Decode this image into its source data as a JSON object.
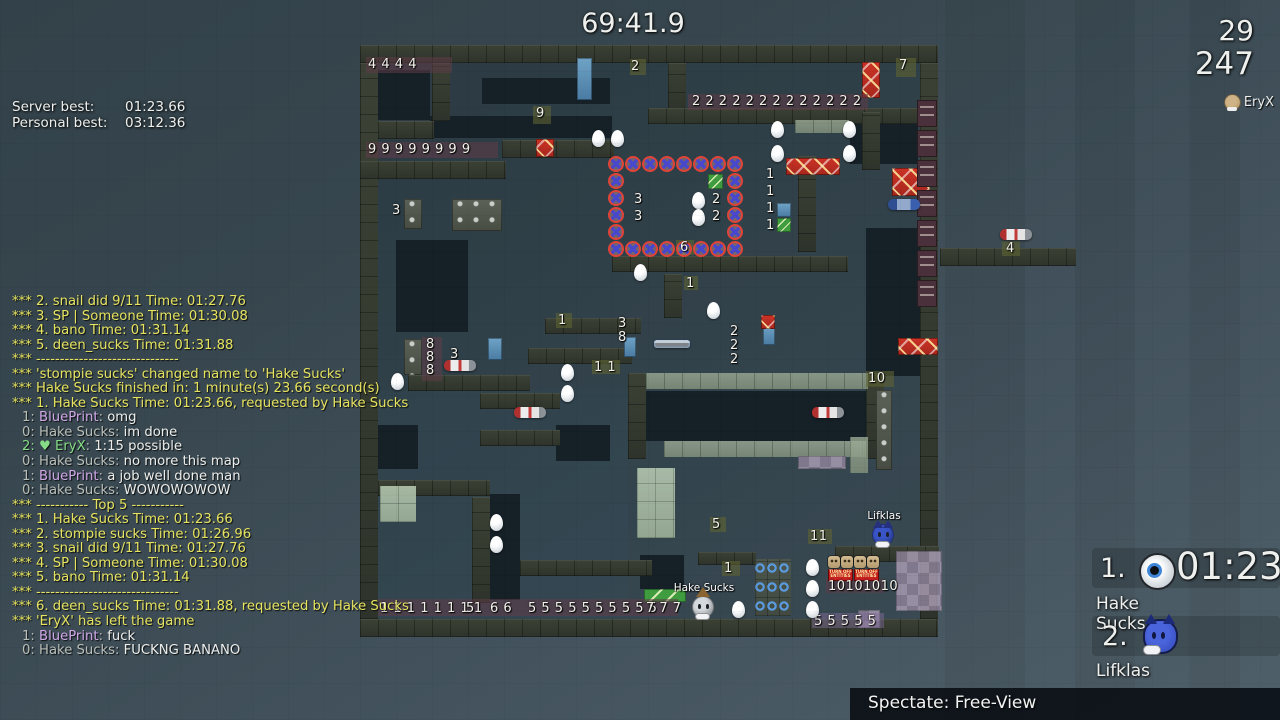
{
  "hud": {
    "timer": "69:41.9",
    "top_right": {
      "value1": "29",
      "value2": "247",
      "spectating_name": "EryX"
    },
    "bests": {
      "server_label": "Server best:",
      "server_value": "01:23.66",
      "personal_label": "Personal best:",
      "personal_value": "03:12.36"
    },
    "spectate_bar": {
      "text": "Spectate: Free-View"
    }
  },
  "chat": {
    "colors": {
      "y": "#e6e360",
      "w": "#eceeec",
      "g": "#b9bfb9",
      "p": "#d0a8e8",
      "gr": "#86dc86"
    },
    "lines": [
      [
        [
          "*** 2. snail did 9/11 Time: 01:27.76",
          "y"
        ]
      ],
      [
        [
          "*** 3. SP | Someone Time: 01:30.08",
          "y"
        ]
      ],
      [
        [
          "*** 4. bano Time: 01:31.14",
          "y"
        ]
      ],
      [
        [
          "*** 5. deen_sucks Time: 01:31.88",
          "y"
        ]
      ],
      [
        [
          "*** ------------------------------",
          "y"
        ]
      ],
      [
        [
          "*** 'stompie sucks' changed name to 'Hake Sucks'",
          "y"
        ]
      ],
      [
        [
          "*** Hake Sucks finished in: 1 minute(s) 23.66 second(s)",
          "y"
        ]
      ],
      [
        [
          "*** 1. Hake Sucks Time: 01:23.66, requested by Hake Sucks",
          "y"
        ]
      ],
      [
        [
          "1: ",
          "g"
        ],
        [
          "BluePrint",
          "p"
        ],
        [
          ": ",
          "g"
        ],
        [
          "omg",
          "w"
        ]
      ],
      [
        [
          "0: ",
          "g"
        ],
        [
          "Hake Sucks",
          "g"
        ],
        [
          ": ",
          "g"
        ],
        [
          "im done",
          "w"
        ]
      ],
      [
        [
          "2: ",
          "gr"
        ],
        [
          "♥ ",
          "gr"
        ],
        [
          "EryX",
          "gr"
        ],
        [
          ": ",
          "g"
        ],
        [
          "1:15 possible",
          "w"
        ]
      ],
      [
        [
          "0: ",
          "g"
        ],
        [
          "Hake Sucks",
          "g"
        ],
        [
          ": ",
          "g"
        ],
        [
          "no more this map",
          "w"
        ]
      ],
      [
        [
          "1: ",
          "g"
        ],
        [
          "BluePrint",
          "p"
        ],
        [
          ": ",
          "g"
        ],
        [
          "a job well done man",
          "w"
        ]
      ],
      [
        [
          "0: ",
          "g"
        ],
        [
          "Hake Sucks",
          "g"
        ],
        [
          ": ",
          "g"
        ],
        [
          "WOWOWOWOW",
          "w"
        ]
      ],
      [
        [
          "*** ----------- Top 5 -----------",
          "y"
        ]
      ],
      [
        [
          "*** 1. Hake Sucks Time: 01:23.66",
          "y"
        ]
      ],
      [
        [
          "*** 2. stompie sucks Time: 01:26.96",
          "y"
        ]
      ],
      [
        [
          "*** 3. snail did 9/11 Time: 01:27.76",
          "y"
        ]
      ],
      [
        [
          "*** 4. SP | Someone Time: 01:30.08",
          "y"
        ]
      ],
      [
        [
          "*** 5. bano Time: 01:31.14",
          "y"
        ]
      ],
      [
        [
          "*** ------------------------------",
          "y"
        ]
      ],
      [
        [
          "*** 6. deen_sucks Time: 01:31.88, requested by Hake Sucks",
          "y"
        ]
      ],
      [
        [
          "*** 'EryX' has left the game",
          "y"
        ]
      ],
      [
        [
          "1: ",
          "g"
        ],
        [
          "BluePrint",
          "p"
        ],
        [
          ": ",
          "g"
        ],
        [
          "fuck",
          "w"
        ]
      ],
      [
        [
          "0: ",
          "g"
        ],
        [
          "Hake Sucks",
          "g"
        ],
        [
          ": ",
          "g"
        ],
        [
          "FUCKNG BANANO",
          "w"
        ]
      ]
    ]
  },
  "leaderboard": {
    "entries": [
      {
        "rank": "1.",
        "time": "01:23",
        "name": "Hake Sucks",
        "skin": "robot"
      },
      {
        "rank": "2.",
        "time": "",
        "name": "Lifklas",
        "skin": "blue-cat"
      }
    ]
  },
  "map": {
    "base": [
      [
        360,
        45,
        578,
        592,
        "rgba(22,40,46,0.28)"
      ],
      [
        378,
        390,
        250,
        228,
        "rgba(45,90,110,0.10)"
      ]
    ],
    "darks": [
      [
        378,
        70,
        52,
        50
      ],
      [
        482,
        78,
        128,
        26
      ],
      [
        430,
        116,
        182,
        22
      ],
      [
        396,
        240,
        72,
        92
      ],
      [
        490,
        494,
        30,
        106
      ],
      [
        646,
        391,
        220,
        50
      ],
      [
        556,
        425,
        54,
        36
      ],
      [
        850,
        118,
        68,
        46
      ],
      [
        378,
        425,
        40,
        44
      ],
      [
        640,
        555,
        44,
        34
      ],
      [
        866,
        228,
        54,
        148
      ]
    ],
    "walls": [
      [
        360,
        45,
        578,
        18
      ],
      [
        360,
        63,
        18,
        574
      ],
      [
        920,
        63,
        18,
        574
      ],
      [
        360,
        619,
        578,
        18
      ],
      [
        432,
        63,
        18,
        58
      ],
      [
        378,
        121,
        56,
        18
      ],
      [
        360,
        161,
        146,
        18
      ],
      [
        502,
        140,
        112,
        18
      ],
      [
        668,
        63,
        18,
        48
      ],
      [
        648,
        108,
        272,
        16
      ],
      [
        862,
        112,
        18,
        58
      ],
      [
        612,
        256,
        236,
        16
      ],
      [
        798,
        156,
        18,
        96
      ],
      [
        545,
        318,
        96,
        16
      ],
      [
        408,
        375,
        122,
        16
      ],
      [
        528,
        348,
        104,
        16
      ],
      [
        628,
        373,
        18,
        86
      ],
      [
        866,
        373,
        18,
        86
      ],
      [
        480,
        393,
        80,
        16
      ],
      [
        480,
        430,
        80,
        16
      ],
      [
        378,
        480,
        112,
        16
      ],
      [
        472,
        497,
        18,
        106
      ],
      [
        835,
        546,
        104,
        16
      ],
      [
        698,
        552,
        58,
        13
      ],
      [
        520,
        560,
        132,
        16
      ],
      [
        940,
        248,
        136,
        18
      ],
      [
        664,
        274,
        18,
        44
      ]
    ],
    "sage": [
      [
        646,
        373,
        222,
        16
      ],
      [
        664,
        441,
        202,
        16
      ],
      [
        795,
        120,
        54,
        13
      ],
      [
        850,
        437,
        18,
        36
      ]
    ],
    "mint": [
      [
        637,
        468,
        38,
        70
      ],
      [
        380,
        486,
        36,
        36
      ]
    ],
    "bluearc": [
      [
        755,
        559,
        36,
        57
      ]
    ],
    "purple": [
      [
        896,
        551,
        46,
        60
      ],
      [
        798,
        456,
        48,
        13
      ],
      [
        858,
        610,
        22,
        18
      ]
    ],
    "green": [
      [
        708,
        174,
        15,
        15
      ],
      [
        644,
        589,
        42,
        13
      ],
      [
        777,
        218,
        14,
        14
      ]
    ],
    "blue": [
      [
        577,
        58,
        15,
        42
      ],
      [
        624,
        337,
        12,
        20
      ],
      [
        763,
        325,
        12,
        20
      ],
      [
        488,
        338,
        14,
        22
      ],
      [
        777,
        203,
        14,
        14
      ]
    ],
    "redx": [
      [
        862,
        62,
        18,
        36
      ],
      [
        786,
        158,
        54,
        17
      ],
      [
        892,
        168,
        38,
        28
      ],
      [
        898,
        338,
        40,
        17
      ],
      [
        536,
        139,
        18,
        18
      ],
      [
        761,
        315,
        14,
        14
      ],
      [
        474,
        202,
        24,
        15
      ]
    ],
    "grey": [
      [
        404,
        199,
        18,
        30
      ],
      [
        452,
        199,
        50,
        32
      ],
      [
        404,
        339,
        18,
        36
      ],
      [
        876,
        390,
        16,
        80
      ]
    ],
    "bands": [
      [
        366,
        57,
        86,
        16
      ],
      [
        366,
        142,
        132,
        16
      ],
      [
        688,
        94,
        180,
        16
      ],
      [
        422,
        337,
        20,
        44
      ],
      [
        378,
        599,
        300,
        17
      ],
      [
        826,
        579,
        58,
        14
      ],
      [
        812,
        613,
        72,
        15,
        "l"
      ],
      [
        896,
        58,
        20,
        19,
        "o"
      ],
      [
        533,
        106,
        18,
        18,
        "o"
      ],
      [
        630,
        59,
        16,
        16,
        "o"
      ],
      [
        556,
        313,
        16,
        15,
        "o"
      ],
      [
        676,
        240,
        18,
        15,
        "o"
      ],
      [
        722,
        561,
        18,
        15,
        "o"
      ],
      [
        866,
        371,
        28,
        16,
        "o"
      ],
      [
        808,
        529,
        24,
        15,
        "o"
      ],
      [
        710,
        517,
        16,
        15,
        "o"
      ],
      [
        1002,
        241,
        18,
        15,
        "o"
      ],
      [
        684,
        276,
        14,
        14,
        "o"
      ],
      [
        592,
        360,
        28,
        14,
        "o"
      ]
    ],
    "labels": [
      [
        368,
        58,
        "4 4 4 4"
      ],
      [
        631,
        60,
        "2"
      ],
      [
        899,
        59,
        "7"
      ],
      [
        536,
        107,
        "9"
      ],
      [
        692,
        95,
        "2 2 2 2 2 2 2 2 2 2 2 2 2"
      ],
      [
        368,
        143,
        "9 9 9 9 9 9 9 9"
      ],
      [
        392,
        204,
        "3"
      ],
      [
        634,
        193,
        "3"
      ],
      [
        634,
        210,
        "3"
      ],
      [
        712,
        193,
        "2"
      ],
      [
        712,
        210,
        "2"
      ],
      [
        680,
        241,
        "6"
      ],
      [
        766,
        168,
        "1"
      ],
      [
        766,
        185,
        "1"
      ],
      [
        766,
        202,
        "1"
      ],
      [
        766,
        219,
        "1"
      ],
      [
        686,
        277,
        "1"
      ],
      [
        558,
        314,
        "1"
      ],
      [
        618,
        317,
        "3"
      ],
      [
        618,
        331,
        "8"
      ],
      [
        730,
        325,
        "2"
      ],
      [
        730,
        339,
        "2"
      ],
      [
        730,
        353,
        "2"
      ],
      [
        426,
        338,
        "8"
      ],
      [
        426,
        351,
        "8"
      ],
      [
        426,
        364,
        "8"
      ],
      [
        450,
        348,
        "3"
      ],
      [
        594,
        361,
        "1 1"
      ],
      [
        868,
        372,
        "10"
      ],
      [
        712,
        518,
        "5"
      ],
      [
        810,
        530,
        "11"
      ],
      [
        724,
        562,
        "1"
      ],
      [
        828,
        580,
        "10101010"
      ],
      [
        380,
        602,
        "1 1 1 1 1 1 1 1"
      ],
      [
        466,
        602,
        "5"
      ],
      [
        490,
        602,
        "6 6"
      ],
      [
        528,
        602,
        "5 5 5 5 5 5 5 5 5 5"
      ],
      [
        646,
        602,
        "7 7 7"
      ],
      [
        814,
        615,
        "5 5 5 5 5"
      ],
      [
        1006,
        242,
        "4"
      ]
    ],
    "circle_ring": {
      "x": 608,
      "y": 156,
      "cols": 8,
      "rows": 6,
      "cell": 17
    },
    "cfh": [
      [
        917,
        100
      ],
      [
        917,
        130
      ],
      [
        917,
        160
      ],
      [
        917,
        190
      ],
      [
        917,
        220
      ],
      [
        917,
        250
      ],
      [
        917,
        280
      ]
    ],
    "smileys": [
      [
        828,
        556
      ],
      [
        841,
        556
      ],
      [
        854,
        556
      ],
      [
        867,
        556
      ]
    ],
    "turnoff": [
      [
        828,
        569,
        25,
        12
      ],
      [
        854,
        569,
        25,
        12
      ]
    ],
    "turnoff_text": "TURN OFF ENTITIES",
    "eggs": [
      [
        592,
        130
      ],
      [
        611,
        130
      ],
      [
        771,
        121
      ],
      [
        843,
        121
      ],
      [
        771,
        145
      ],
      [
        843,
        145
      ],
      [
        634,
        264
      ],
      [
        707,
        302
      ],
      [
        692,
        192
      ],
      [
        692,
        209
      ],
      [
        561,
        364
      ],
      [
        561,
        385
      ],
      [
        391,
        373
      ],
      [
        490,
        514
      ],
      [
        490,
        536
      ],
      [
        806,
        559
      ],
      [
        806,
        580
      ],
      [
        806,
        601
      ],
      [
        732,
        601
      ]
    ],
    "pickups": [
      {
        "x": 514,
        "y": 407,
        "type": "grenade"
      },
      {
        "x": 812,
        "y": 407,
        "type": "grenade"
      },
      {
        "x": 444,
        "y": 360,
        "type": "grenade"
      },
      {
        "x": 1000,
        "y": 229,
        "type": "grenade"
      },
      {
        "x": 654,
        "y": 340,
        "type": "laser"
      },
      {
        "x": 888,
        "y": 199,
        "type": "shotgun"
      }
    ],
    "players": [
      {
        "x": 872,
        "y": 524,
        "name": "Lifklas",
        "body": "#3a55c8",
        "style": "cat"
      },
      {
        "x": 692,
        "y": 596,
        "name": "Hake Sucks",
        "body": "#d4d9de",
        "style": "robot",
        "hat": "#8a6430"
      }
    ]
  }
}
